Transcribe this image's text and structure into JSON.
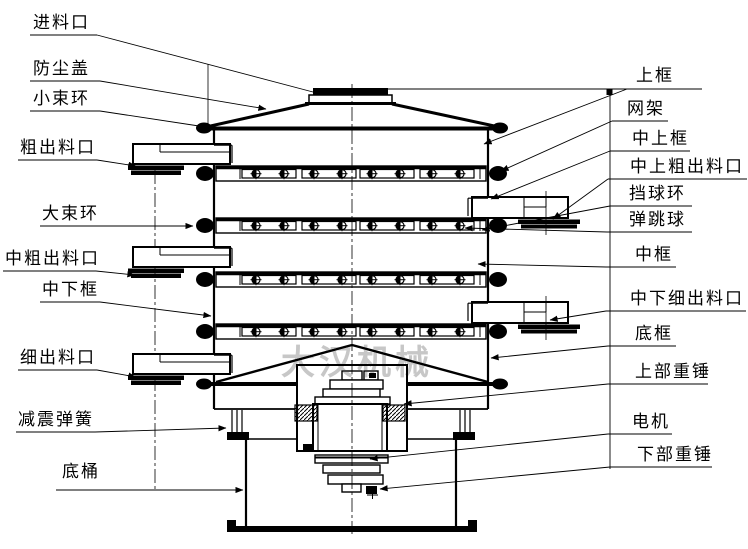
{
  "diagram": {
    "type": "technical-cross-section-drawing",
    "watermark": "大汉机械",
    "colors": {
      "line": "#000000",
      "background": "#ffffff",
      "watermark": "#c7c7c7"
    },
    "labels_left": [
      {
        "text": "进料口"
      },
      {
        "text": "防尘盖"
      },
      {
        "text": "小束环"
      },
      {
        "text": "粗出料口"
      },
      {
        "text": "大束环"
      },
      {
        "text": "中粗出料口"
      },
      {
        "text": "中下框"
      },
      {
        "text": "细出料口"
      },
      {
        "text": "减震弹簧"
      },
      {
        "text": "底桶"
      }
    ],
    "labels_right": [
      {
        "text": "上框"
      },
      {
        "text": "网架"
      },
      {
        "text": "中上框"
      },
      {
        "text": "中上粗出料口"
      },
      {
        "text": "挡球环"
      },
      {
        "text": "弹跳球"
      },
      {
        "text": "中框"
      },
      {
        "text": "中下细出料口"
      },
      {
        "text": "底框"
      },
      {
        "text": "上部重锤"
      },
      {
        "text": "电机"
      },
      {
        "text": "下部重锤"
      }
    ]
  }
}
